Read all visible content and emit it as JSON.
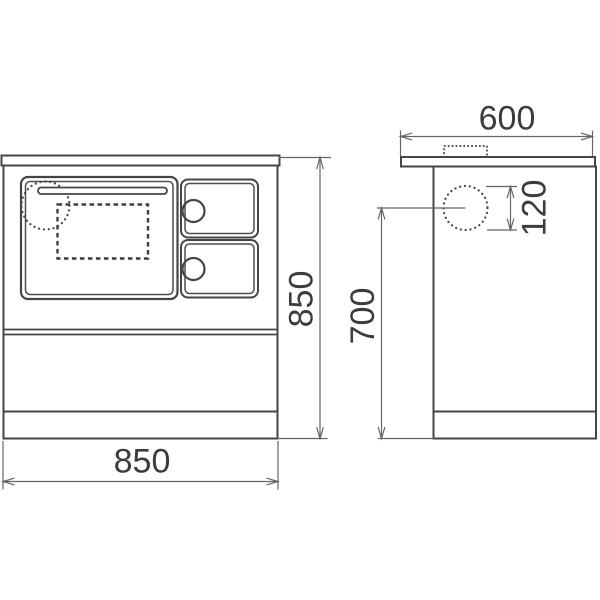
{
  "drawing": {
    "kind": "technical-dimension-drawing",
    "views": {
      "front": "front view of cooker with oven door, handle, two control knobs",
      "side": "side view of cooker with flue outlet circle and flue collar"
    },
    "labels": {
      "depth": "600",
      "flue_diameter": "120",
      "flue_center_height": "700",
      "height": "850",
      "width": "850"
    },
    "colors": {
      "background": "#ffffff",
      "outline": "#454545",
      "dimension_lines": "#656565",
      "text": "#3c3c3c"
    }
  }
}
